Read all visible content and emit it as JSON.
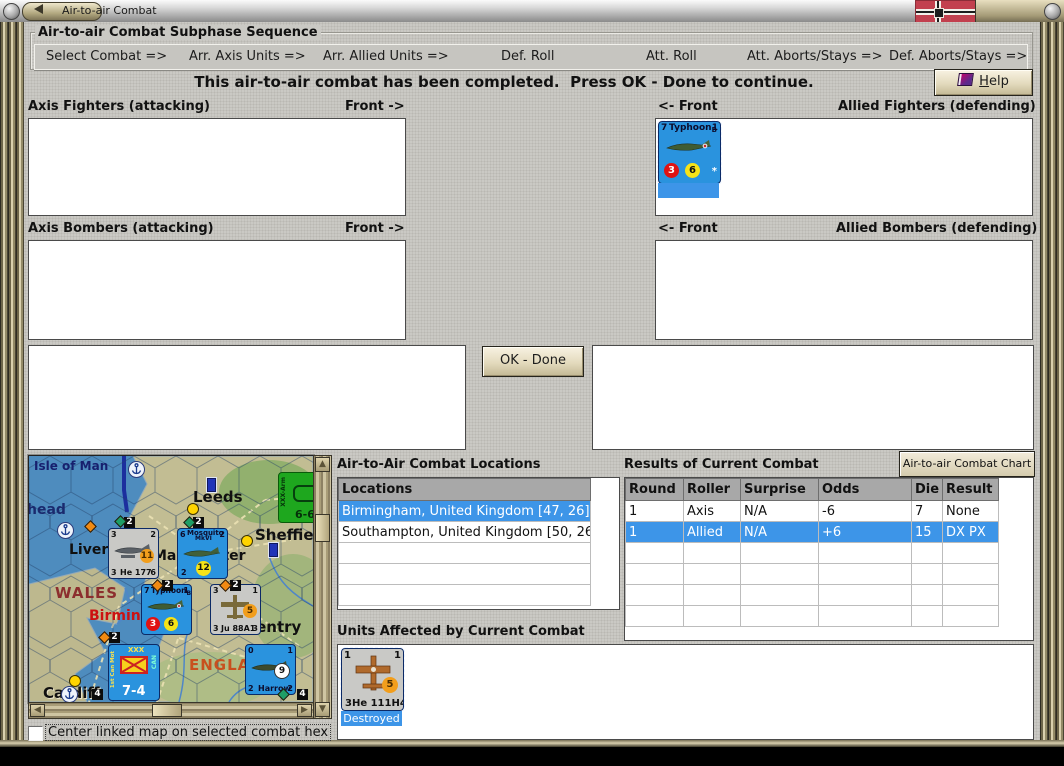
{
  "window": {
    "title": "Air-to-air Combat"
  },
  "sequence": {
    "title": "Air-to-air Combat Subphase Sequence",
    "steps": [
      "Select Combat =>",
      "Arr. Axis Units =>",
      "Arr. Allied Units =>",
      "Def. Roll",
      "Att. Roll",
      "Att. Aborts/Stays =>",
      "Def. Aborts/Stays =>"
    ]
  },
  "message": "This air-to-air combat has been completed.  Press OK - Done to continue.",
  "help": {
    "initial": "H",
    "rest": "elp"
  },
  "sections": {
    "axis_fighters": "Axis Fighters (attacking)",
    "axis_fighters_front": "Front ->",
    "allied_fighters_front": "<- Front",
    "allied_fighters": "Allied Fighters (defending)",
    "axis_bombers": "Axis Bombers (attacking)",
    "axis_bombers_front": "Front ->",
    "allied_bombers_front": "<- Front",
    "allied_bombers": "Allied Bombers (defending)"
  },
  "ok_button": "OK - Done",
  "locations": {
    "title": "Air-to-Air Combat Locations",
    "header": "Locations",
    "rows": [
      {
        "text": "Birmingham, United Kingdom [47, 26]"
      },
      {
        "text": "Southampton, United Kingdom [50, 26]"
      }
    ]
  },
  "results": {
    "title": "Results of Current Combat",
    "chart_button": "Air-to-air Combat Chart",
    "headers": [
      "Round",
      "Roller",
      "Surprise",
      "Odds",
      "Die",
      "Result"
    ],
    "rows": [
      [
        "1",
        "Axis",
        "N/A",
        "-6",
        "7",
        "None"
      ],
      [
        "1",
        "Allied",
        "N/A",
        "+6",
        "15",
        "DX PX"
      ]
    ]
  },
  "affected": {
    "title": "Units Affected by Current Combat"
  },
  "units": {
    "typhoon": {
      "tl": "7",
      "name": "Typhoon",
      "sub": "B",
      "tr": "1",
      "red": "3",
      "yellow": "6",
      "star": "*"
    },
    "he111": {
      "tl": "1",
      "tr": "1",
      "chip": "5",
      "name": "3He 111H4",
      "status": "Destroyed"
    }
  },
  "map": {
    "labels": {
      "isle_of_man": "Isle of Man",
      "head": "head",
      "liverpool": "Liverpool",
      "manchester": "Manchester",
      "leeds": "Leeds",
      "sheffield": "Sheffield",
      "wales": "WALES",
      "birmingham": "Birmingham",
      "coventry": "Coventry",
      "england": "ENGLAND",
      "cardiff": "Cardiff"
    },
    "counters": {
      "he177": {
        "tl": "3",
        "tr": "2",
        "chip": "11",
        "bl": "3",
        "name": "He 177",
        "br": "6"
      },
      "mosquito": {
        "tl": "6",
        "name": "Mosquito",
        "name2": "MkVI",
        "tr": "2",
        "chip": "12",
        "bl": "2"
      },
      "armor": {
        "top": "XXX",
        "side": "XXX-Arm",
        "bottom": "6-6"
      },
      "typhoon": {
        "tl": "7",
        "name": "Typhoon",
        "sub": "B",
        "tr": "1",
        "red": "3",
        "yellow": "6"
      },
      "ju88": {
        "tl": "3",
        "tr": "1",
        "chip": "5",
        "bl": "3",
        "name": "Ju 88A1",
        "br": "3"
      },
      "div74": {
        "top": "XXX",
        "left": "1st Can Mot",
        "right": "CAN",
        "bottom": "7-4"
      },
      "harrow": {
        "tl": "0",
        "tr": "1",
        "chip": "9",
        "bl": "2",
        "name": "Harrow",
        "br": "2"
      }
    },
    "badges": [
      "2",
      "2",
      "2",
      "2",
      "2",
      "4",
      "4"
    ]
  },
  "checkbox": {
    "label": "Center linked map on selected combat hex"
  },
  "colors": {
    "selection": "#3d95e8",
    "counter_blue": "#2a93de",
    "counter_gray": "#c9c9c6",
    "armor_green": "#1ea71e",
    "frame_tan": "#b3a981",
    "header_gray": "#a8a8a8"
  }
}
